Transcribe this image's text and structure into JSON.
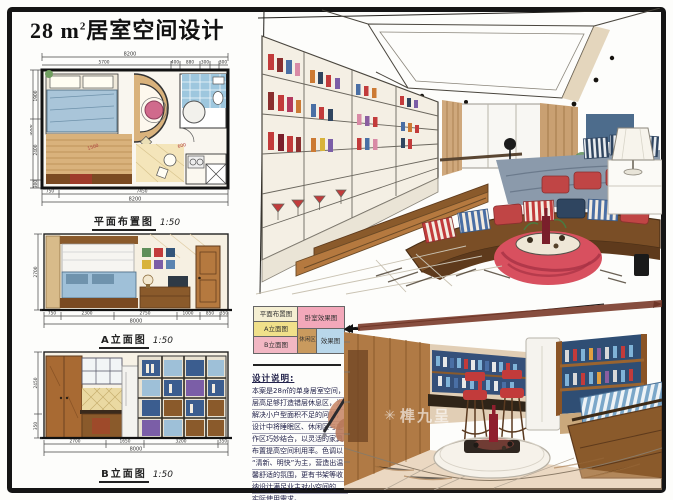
{
  "page": {
    "title_num": "28 m",
    "title_sup": "2",
    "title_rest": "居室空间设计"
  },
  "palette": {
    "frame": "#151515",
    "paper": "#fdfdfb",
    "wood": "#b07a45",
    "wood_dark": "#7a4a22",
    "marker_red": "#c23b3b",
    "marker_blue": "#5b84b1",
    "marker_navy": "#33557a",
    "marker_tan": "#c9a876",
    "accent_pink": "#d06a8c"
  },
  "floor_plan": {
    "label": "平面布置图",
    "scale": "1:50",
    "dim_top_total": "8200",
    "dim_top_segs": [
      "5700",
      "400",
      "880",
      "300",
      "300"
    ],
    "dim_bottom_segs": [
      "750",
      "7450"
    ],
    "dim_bottom_total": "8200",
    "dim_left_total": "4000",
    "dim_left_segs": [
      "1900",
      "2400",
      "300"
    ],
    "interior_labels": [
      "1500",
      "600"
    ]
  },
  "elevation_a": {
    "label": "A立面图",
    "scale": "1:50",
    "dim_left": "2700",
    "dim_bottom_segs": [
      "750",
      "2300",
      "2750",
      "1000",
      "850",
      "350"
    ],
    "dim_bottom_total": "8000"
  },
  "elevation_b": {
    "label": "B立面图",
    "scale": "1:50",
    "dim_left_segs": [
      "2450",
      "350"
    ],
    "dim_bottom_segs": [
      "2700",
      "1650",
      "3200",
      "350"
    ],
    "dim_bottom_total": "8000"
  },
  "legend": {
    "plan": "平面布置图",
    "elev_a": "A立面图",
    "elev_b": "B立面图",
    "render_bedroom": "卧室效果图",
    "render_lounge_zone": "休闲区",
    "render_lounge": "效果图"
  },
  "notes": {
    "heading": "设计说明:",
    "lines": [
      "本案是28㎡的单身居室空间，",
      "层高足够打造错层休息区，为",
      "解决小户型面积不足的问题，",
      "设计中将睡眠区、休闲区与工",
      "作区巧妙结合，以灵活的家具",
      "布置提高空间利用率。色调以",
      "“清新、明快”为主，营造出温",
      "馨舒适的氛围，更有书架等收",
      "纳设计满足业主对小空间的",
      "实际使用需求。"
    ]
  },
  "watermark": {
    "star": "✳",
    "text": "榫九呈"
  }
}
